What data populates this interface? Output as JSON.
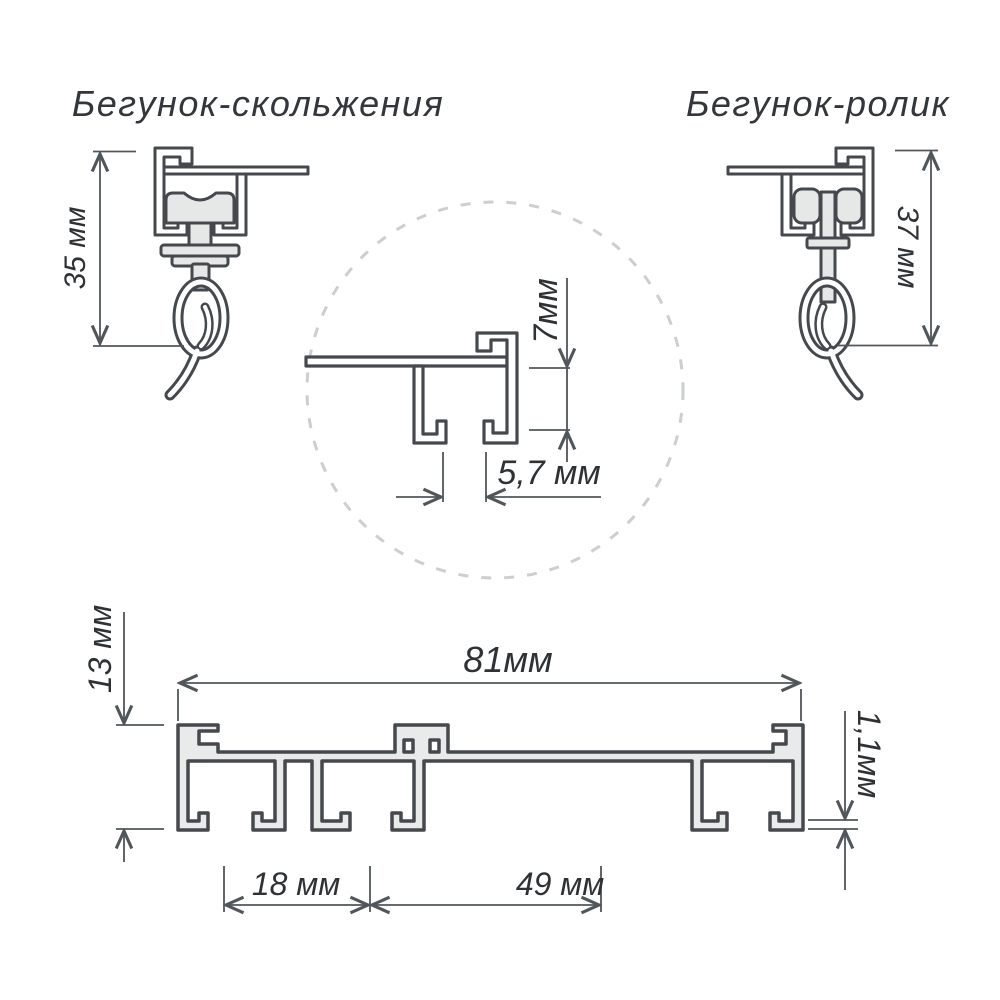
{
  "titles": {
    "slider": "Бегунок-скольжения",
    "roller": "Бегунок-ролик"
  },
  "dimensions": {
    "slider_height": "35 мм",
    "roller_height": "37 мм",
    "detail_depth": "7мм",
    "detail_slot_width": "5,7 мм",
    "profile_height": "13 мм",
    "profile_width": "81мм",
    "wall_thickness": "1,1мм",
    "track_spacing_1": "18 мм",
    "track_spacing_2": "49 мм"
  },
  "colors": {
    "outline": "#45494d",
    "dimension_line": "#51565a",
    "profile_fill": "#e9ebea",
    "runner_fill": "#e6e8e8",
    "dashed_circle": "#cbcfce",
    "text": "#2f3235",
    "background": "#ffffff"
  }
}
